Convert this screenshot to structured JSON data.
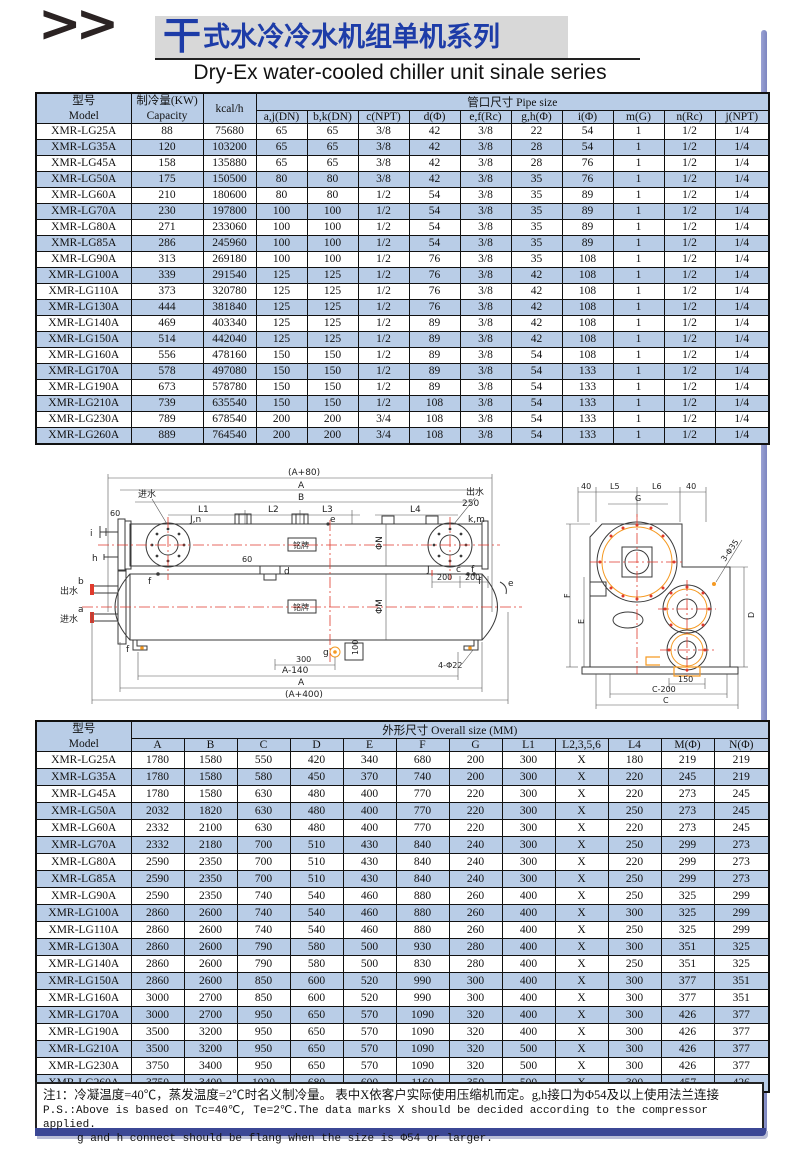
{
  "page": {
    "chevrons": ">>",
    "title_first": "干",
    "title_rest": "式水冷冷水机组单机系列",
    "subtitle": "Dry-Ex water-cooled chiller unit sinale series"
  },
  "colors": {
    "title_blue": "#1d3ca8",
    "table_header_bg": "#b9cde7",
    "accent_rail": "#8d96cb",
    "bottom_bar": "#3b4795",
    "centerline_red": "#e03a2c",
    "accent_orange": "#f59a23"
  },
  "table1": {
    "header": {
      "model_cn": "型号",
      "model_en": "Model",
      "capacity_cn": "制冷量(KW)",
      "capacity_en": "Capacity",
      "kcal": "kcal/h",
      "pipe_size": "管口尺寸 Pipe size",
      "cols": [
        "a,j(DN)",
        "b,k(DN)",
        "c(NPT)",
        "d(Φ)",
        "e,f(Rc)",
        "g,h(Φ)",
        "i(Φ)",
        "m(G)",
        "n(Rc)",
        "j(NPT)"
      ]
    },
    "rows": [
      [
        "XMR-LG25A",
        "88",
        "75680",
        "65",
        "65",
        "3/8",
        "42",
        "3/8",
        "22",
        "54",
        "1",
        "1/2",
        "1/4"
      ],
      [
        "XMR-LG35A",
        "120",
        "103200",
        "65",
        "65",
        "3/8",
        "42",
        "3/8",
        "28",
        "54",
        "1",
        "1/2",
        "1/4"
      ],
      [
        "XMR-LG45A",
        "158",
        "135880",
        "65",
        "65",
        "3/8",
        "42",
        "3/8",
        "28",
        "76",
        "1",
        "1/2",
        "1/4"
      ],
      [
        "XMR-LG50A",
        "175",
        "150500",
        "80",
        "80",
        "3/8",
        "42",
        "3/8",
        "35",
        "76",
        "1",
        "1/2",
        "1/4"
      ],
      [
        "XMR-LG60A",
        "210",
        "180600",
        "80",
        "80",
        "1/2",
        "54",
        "3/8",
        "35",
        "89",
        "1",
        "1/2",
        "1/4"
      ],
      [
        "XMR-LG70A",
        "230",
        "197800",
        "100",
        "100",
        "1/2",
        "54",
        "3/8",
        "35",
        "89",
        "1",
        "1/2",
        "1/4"
      ],
      [
        "XMR-LG80A",
        "271",
        "233060",
        "100",
        "100",
        "1/2",
        "54",
        "3/8",
        "35",
        "89",
        "1",
        "1/2",
        "1/4"
      ],
      [
        "XMR-LG85A",
        "286",
        "245960",
        "100",
        "100",
        "1/2",
        "54",
        "3/8",
        "35",
        "89",
        "1",
        "1/2",
        "1/4"
      ],
      [
        "XMR-LG90A",
        "313",
        "269180",
        "100",
        "100",
        "1/2",
        "76",
        "3/8",
        "35",
        "108",
        "1",
        "1/2",
        "1/4"
      ],
      [
        "XMR-LG100A",
        "339",
        "291540",
        "125",
        "125",
        "1/2",
        "76",
        "3/8",
        "42",
        "108",
        "1",
        "1/2",
        "1/4"
      ],
      [
        "XMR-LG110A",
        "373",
        "320780",
        "125",
        "125",
        "1/2",
        "76",
        "3/8",
        "42",
        "108",
        "1",
        "1/2",
        "1/4"
      ],
      [
        "XMR-LG130A",
        "444",
        "381840",
        "125",
        "125",
        "1/2",
        "76",
        "3/8",
        "42",
        "108",
        "1",
        "1/2",
        "1/4"
      ],
      [
        "XMR-LG140A",
        "469",
        "403340",
        "125",
        "125",
        "1/2",
        "89",
        "3/8",
        "42",
        "108",
        "1",
        "1/2",
        "1/4"
      ],
      [
        "XMR-LG150A",
        "514",
        "442040",
        "125",
        "125",
        "1/2",
        "89",
        "3/8",
        "42",
        "108",
        "1",
        "1/2",
        "1/4"
      ],
      [
        "XMR-LG160A",
        "556",
        "478160",
        "150",
        "150",
        "1/2",
        "89",
        "3/8",
        "54",
        "108",
        "1",
        "1/2",
        "1/4"
      ],
      [
        "XMR-LG170A",
        "578",
        "497080",
        "150",
        "150",
        "1/2",
        "89",
        "3/8",
        "54",
        "133",
        "1",
        "1/2",
        "1/4"
      ],
      [
        "XMR-LG190A",
        "673",
        "578780",
        "150",
        "150",
        "1/2",
        "89",
        "3/8",
        "54",
        "133",
        "1",
        "1/2",
        "1/4"
      ],
      [
        "XMR-LG210A",
        "739",
        "635540",
        "150",
        "150",
        "1/2",
        "108",
        "3/8",
        "54",
        "133",
        "1",
        "1/2",
        "1/4"
      ],
      [
        "XMR-LG230A",
        "789",
        "678540",
        "200",
        "200",
        "3/4",
        "108",
        "3/8",
        "54",
        "133",
        "1",
        "1/2",
        "1/4"
      ],
      [
        "XMR-LG260A",
        "889",
        "764540",
        "200",
        "200",
        "3/4",
        "108",
        "3/8",
        "54",
        "133",
        "1",
        "1/2",
        "1/4"
      ]
    ]
  },
  "diagram": {
    "labels": {
      "a80": "(A+80)",
      "a_top": "A",
      "b_top": "B",
      "l1": "L1",
      "l2": "L2",
      "l3": "L3",
      "l4": "L4",
      "d250": "250",
      "in_top": "进水",
      "out_top": "出水",
      "jn": "J,n",
      "km": "k,m",
      "e_top": "e",
      "d": "d",
      "f_l": "f",
      "f_r": "f",
      "n60": "60",
      "n60b": "60",
      "i": "i",
      "h": "h",
      "b_left": "b",
      "out_left": "出水",
      "a_left": "a",
      "in_left": "进水",
      "f_bl": "f",
      "phiN": "ΦN",
      "phiM": "ΦM",
      "plate1": "铭牌",
      "plate2": "铭牌",
      "J": "J",
      "c_s": "c",
      "f_r2": "f",
      "e_r": "e",
      "n200a": "200",
      "n200b": "200",
      "g": "g",
      "n100": "100",
      "n300": "300",
      "phi22": "4-Φ22",
      "a140": "A-140",
      "a_bot": "A",
      "a400": "(A+400)",
      "n40a": "40",
      "l5": "L5",
      "l6": "L6",
      "n40b": "40",
      "G": "G",
      "F": "F",
      "E": "E",
      "D": "D",
      "n150": "150",
      "c200": "C-200",
      "C": "C",
      "phi35": "3-Φ35"
    }
  },
  "table2": {
    "header": {
      "model_cn": "型号",
      "model_en": "Model",
      "overall": "外形尺寸 Overall size (MM)",
      "cols": [
        "A",
        "B",
        "C",
        "D",
        "E",
        "F",
        "G",
        "L1",
        "L2,3,5,6",
        "L4",
        "M(Φ)",
        "N(Φ)"
      ]
    },
    "rows": [
      [
        "XMR-LG25A",
        "1780",
        "1580",
        "550",
        "420",
        "340",
        "680",
        "200",
        "300",
        "X",
        "180",
        "219",
        "219"
      ],
      [
        "XMR-LG35A",
        "1780",
        "1580",
        "580",
        "450",
        "370",
        "740",
        "200",
        "300",
        "X",
        "220",
        "245",
        "219"
      ],
      [
        "XMR-LG45A",
        "1780",
        "1580",
        "630",
        "480",
        "400",
        "770",
        "220",
        "300",
        "X",
        "220",
        "273",
        "245"
      ],
      [
        "XMR-LG50A",
        "2032",
        "1820",
        "630",
        "480",
        "400",
        "770",
        "220",
        "300",
        "X",
        "250",
        "273",
        "245"
      ],
      [
        "XMR-LG60A",
        "2332",
        "2100",
        "630",
        "480",
        "400",
        "770",
        "220",
        "300",
        "X",
        "220",
        "273",
        "245"
      ],
      [
        "XMR-LG70A",
        "2332",
        "2180",
        "700",
        "510",
        "430",
        "840",
        "240",
        "300",
        "X",
        "250",
        "299",
        "273"
      ],
      [
        "XMR-LG80A",
        "2590",
        "2350",
        "700",
        "510",
        "430",
        "840",
        "240",
        "300",
        "X",
        "220",
        "299",
        "273"
      ],
      [
        "XMR-LG85A",
        "2590",
        "2350",
        "700",
        "510",
        "430",
        "840",
        "240",
        "300",
        "X",
        "250",
        "299",
        "273"
      ],
      [
        "XMR-LG90A",
        "2590",
        "2350",
        "740",
        "540",
        "460",
        "880",
        "260",
        "400",
        "X",
        "250",
        "325",
        "299"
      ],
      [
        "XMR-LG100A",
        "2860",
        "2600",
        "740",
        "540",
        "460",
        "880",
        "260",
        "400",
        "X",
        "300",
        "325",
        "299"
      ],
      [
        "XMR-LG110A",
        "2860",
        "2600",
        "740",
        "540",
        "460",
        "880",
        "260",
        "400",
        "X",
        "250",
        "325",
        "299"
      ],
      [
        "XMR-LG130A",
        "2860",
        "2600",
        "790",
        "580",
        "500",
        "930",
        "280",
        "400",
        "X",
        "300",
        "351",
        "325"
      ],
      [
        "XMR-LG140A",
        "2860",
        "2600",
        "790",
        "580",
        "500",
        "830",
        "280",
        "400",
        "X",
        "250",
        "351",
        "325"
      ],
      [
        "XMR-LG150A",
        "2860",
        "2600",
        "850",
        "600",
        "520",
        "990",
        "300",
        "400",
        "X",
        "300",
        "377",
        "351"
      ],
      [
        "XMR-LG160A",
        "3000",
        "2700",
        "850",
        "600",
        "520",
        "990",
        "300",
        "400",
        "X",
        "300",
        "377",
        "351"
      ],
      [
        "XMR-LG170A",
        "3000",
        "2700",
        "950",
        "650",
        "570",
        "1090",
        "320",
        "400",
        "X",
        "300",
        "426",
        "377"
      ],
      [
        "XMR-LG190A",
        "3500",
        "3200",
        "950",
        "650",
        "570",
        "1090",
        "320",
        "400",
        "X",
        "300",
        "426",
        "377"
      ],
      [
        "XMR-LG210A",
        "3500",
        "3200",
        "950",
        "650",
        "570",
        "1090",
        "320",
        "500",
        "X",
        "300",
        "426",
        "377"
      ],
      [
        "XMR-LG230A",
        "3750",
        "3400",
        "950",
        "650",
        "570",
        "1090",
        "320",
        "500",
        "X",
        "300",
        "426",
        "377"
      ],
      [
        "XMR-LG260A",
        "3750",
        "3400",
        "1020",
        "680",
        "600",
        "1160",
        "350",
        "500",
        "X",
        "300",
        "457",
        "426"
      ]
    ]
  },
  "notes": {
    "line1": "注1：冷凝温度=40℃，蒸发温度=2℃时名义制冷量。 表中X依客户实际使用压缩机而定。g,h接口为Φ54及以上使用法兰连接",
    "line2": "P.S.:Above is based on Tc=40℃, Te=2℃.The data marks X should be decided according to the compressor applied.",
    "line3": "g and h connect should be flang when the size is Φ54 or larger."
  }
}
